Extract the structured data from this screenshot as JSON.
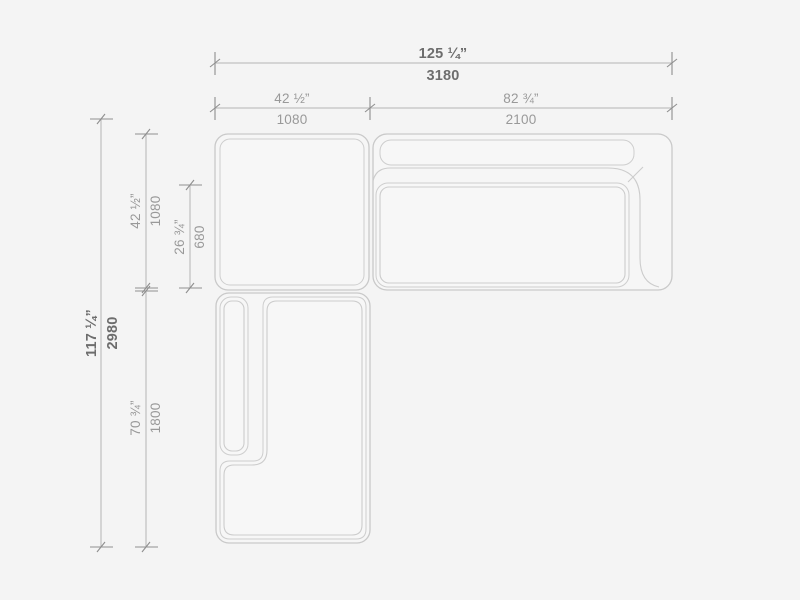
{
  "drawing": {
    "type": "sectional-sofa-plan-view",
    "background_color": "#f4f4f4",
    "outline_color": "#c9c9c9",
    "dimension_line_color": "#b5b5b5",
    "tick_color": "#8f8f8f",
    "bold_text_color": "#6d6d6d",
    "regular_text_color": "#999999"
  },
  "dimensions": {
    "overall_width": {
      "inches": "125 ¼”",
      "mm": "3180"
    },
    "left_module_width": {
      "inches": "42 ½”",
      "mm": "1080"
    },
    "right_module_width": {
      "inches": "82 ¾”",
      "mm": "2100"
    },
    "overall_depth": {
      "inches": "117 ¼”",
      "mm": "2980"
    },
    "corner_module_depth": {
      "inches": "42 ½”",
      "mm": "1080"
    },
    "seat_depth": {
      "inches": "26 ¾”",
      "mm": "680"
    },
    "chaise_module_length": {
      "inches": "70 ¾”",
      "mm": "1800"
    }
  }
}
